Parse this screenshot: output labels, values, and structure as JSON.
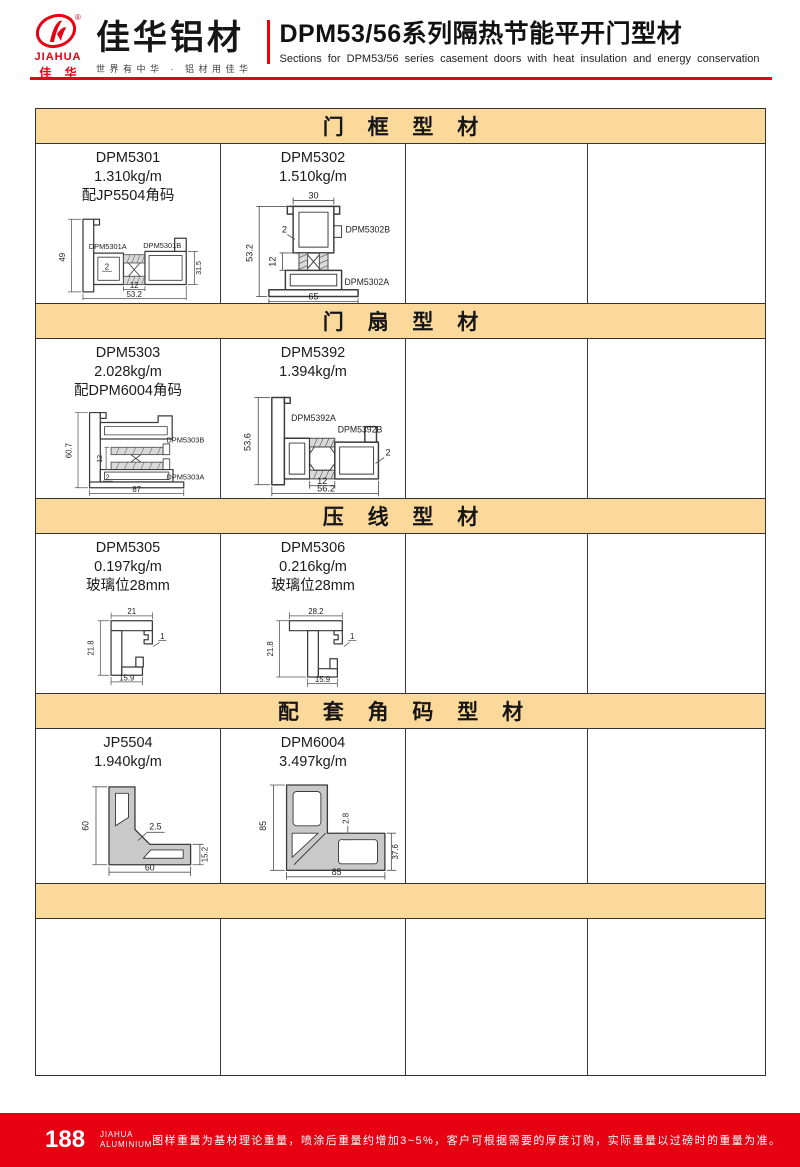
{
  "header": {
    "logo": {
      "brand_en": "JIAHUA",
      "brand_cn": "佳 华",
      "registered": "®",
      "company": "佳华铝材",
      "tagline": "世界有中华 · 铝材用佳华"
    },
    "title": "DPM53/56系列隔热节能平开门型材",
    "subtitle": "Sections for DPM53/56 series casement doors with heat insulation and energy conservation"
  },
  "colors": {
    "brand_red": "#E60012",
    "section_band_bg": "#FBD99B",
    "table_line": "#3a3a3a"
  },
  "sections": [
    {
      "title": "门 框 型 材",
      "profiles": [
        {
          "code": "DPM5301",
          "weight": "1.310kg/m",
          "note": "配JP5504角码",
          "part_labels": [
            "DPM5301A",
            "DPM5301B"
          ],
          "dims": {
            "height": "49",
            "right_height": "31.5",
            "break": "12",
            "width": "53.2",
            "wall": "2"
          }
        },
        {
          "code": "DPM5302",
          "weight": "1.510kg/m",
          "note": "",
          "part_labels": [
            "DPM5302B",
            "DPM5302A"
          ],
          "dims": {
            "top": "30",
            "height": "53.2",
            "break": "12",
            "width": "65",
            "wall": "2"
          }
        }
      ]
    },
    {
      "title": "门 扇 型 材",
      "profiles": [
        {
          "code": "DPM5303",
          "weight": "2.028kg/m",
          "note": "配DPM6004角码",
          "part_labels": [
            "DPM5303B",
            "DPM5303A"
          ],
          "dims": {
            "height": "60.7",
            "break": "12",
            "width": "87",
            "wall": "2"
          }
        },
        {
          "code": "DPM5392",
          "weight": "1.394kg/m",
          "note": "",
          "part_labels": [
            "DPM5392A",
            "DPM5392B"
          ],
          "dims": {
            "height": "53.6",
            "break": "12",
            "width": "56.2",
            "wall": "2"
          }
        }
      ]
    },
    {
      "title": "压 线 型 材",
      "profiles": [
        {
          "code": "DPM5305",
          "weight": "0.197kg/m",
          "note": "玻璃位28mm",
          "part_labels": [],
          "dims": {
            "top": "21",
            "height": "21.8",
            "width": "15.9",
            "wall": "1"
          }
        },
        {
          "code": "DPM5306",
          "weight": "0.216kg/m",
          "note": "玻璃位28mm",
          "part_labels": [],
          "dims": {
            "top": "28.2",
            "height": "21.8",
            "width": "15.9",
            "wall": "1"
          }
        }
      ]
    },
    {
      "title": "配 套 角 码 型 材",
      "profiles": [
        {
          "code": "JP5504",
          "weight": "1.940kg/m",
          "note": "",
          "part_labels": [],
          "dims": {
            "height": "60",
            "width": "60",
            "right_height": "15.2",
            "wall": "2.5"
          }
        },
        {
          "code": "DPM6004",
          "weight": "3.497kg/m",
          "note": "",
          "part_labels": [],
          "dims": {
            "height": "85",
            "width": "85",
            "right_height": "37.6",
            "wall": "2.8"
          }
        }
      ]
    },
    {
      "title": "",
      "profiles": []
    }
  ],
  "footer": {
    "page_number": "188",
    "brand_line1": "JIAHUA",
    "brand_line2": "ALUMINIUM",
    "disclaimer": "图样重量为基材理论重量，喷涂后重量约增加3~5%，客户可根据需要的厚度订购，实际重量以过磅时的重量为准。"
  }
}
